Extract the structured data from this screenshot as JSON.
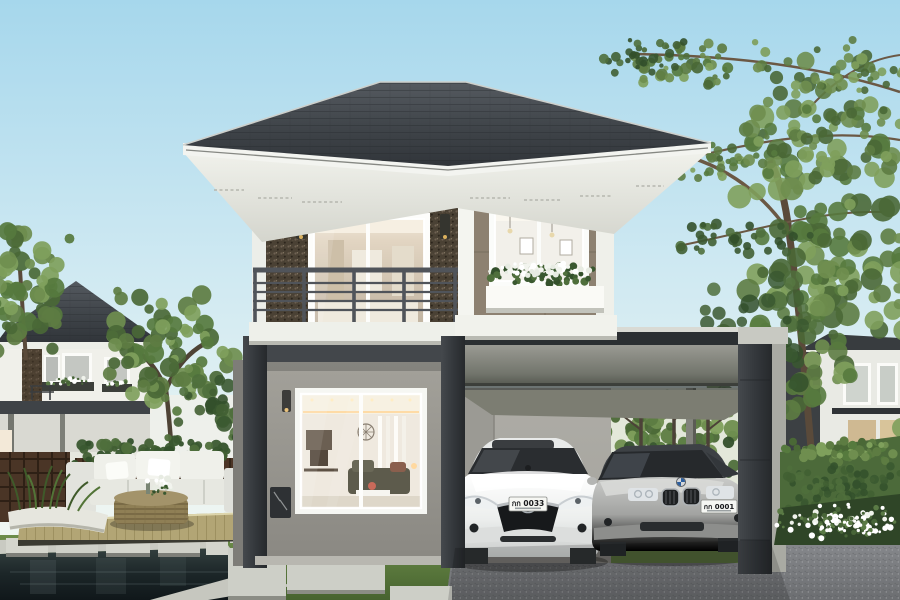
{
  "scene": {
    "type": "architectural-exterior-rendering",
    "description": "Modern two-storey detached house with wide hipped roof, stone feature wall, balcony, attached flat-roof carport sheltering two sedans, front lawn with concrete pavers, timber lounge deck and reflecting pond, neighbouring houses and trees",
    "sky": {
      "top": "#a6d7ec",
      "mid": "#cfe9f2",
      "horizon": "#f3f7f2"
    },
    "main_house": {
      "roof": "#3d4247",
      "fascia": "#f2f3ef",
      "soffit": "#e9eae4",
      "feature_wall": "#4a4134",
      "taupe_wall": "#8d8171",
      "trim": "#f2f3ee",
      "lower_wall": "#9a988f",
      "frame": "#3f4347",
      "railing": "#50545a"
    },
    "carport": {
      "beam_face": "#8f9088",
      "pillar": "#2e3236",
      "inner_wall": "#b3b2ac"
    },
    "cars": [
      {
        "label": "white sedan",
        "body": "#f1f3f2",
        "plate": "กก 0033"
      },
      {
        "label": "silver sedan",
        "body": "#a7a8a6",
        "plate": "กก 0001"
      }
    ],
    "landscape": {
      "lawn": "#5e7d43",
      "driveway": "#87898c",
      "deck": "#b2a575",
      "pond": "#1d2629",
      "hedge": "#4c6a3a",
      "paver": "#cdcfc7",
      "planter": "#e6e6de",
      "flowers": "#ffffff"
    },
    "foliage_palettes": {
      "green": [
        "#4a6836",
        "#5d7c42",
        "#6f8e4f",
        "#7fa05c",
        "#567a3e"
      ],
      "darkgreen": [
        "#33502b",
        "#415f33",
        "#4f6f3c",
        "#3a5830"
      ],
      "white": [
        "#ffffff",
        "#f2f4ee",
        "#e7ebe2"
      ],
      "flowerbed": [
        "#ffffff",
        "#f0f3ec",
        "#ffffff",
        "#5a7a45",
        "#486538"
      ]
    },
    "objects": [
      "two-storey house",
      "hipped roof",
      "balcony with metal railing",
      "stone feature wall",
      "flower window box",
      "carport",
      "white sedan",
      "silver sedan",
      "front lawn",
      "concrete pavers",
      "gravel driveway",
      "timber deck",
      "outdoor sofa",
      "wicker table",
      "reflecting pond",
      "stepping stones",
      "hedge",
      "white flower bed",
      "trees",
      "neighbour houses"
    ]
  }
}
